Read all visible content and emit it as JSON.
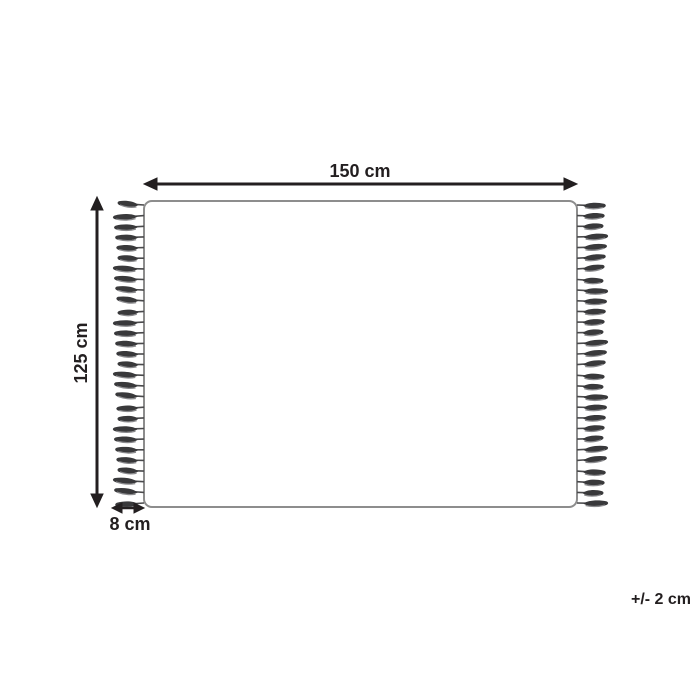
{
  "diagram": {
    "type": "product-dimension-diagram",
    "subject": "rug-with-fringe",
    "width_label": "150 cm",
    "height_label": "125 cm",
    "fringe_label": "8 cm",
    "tolerance_label": "+/- 2 cm",
    "tassels_per_side": 29,
    "colors": {
      "background": "#ffffff",
      "outline_ink": "#231f20",
      "rug_border": "#8d8d8d",
      "tassel_dark": "#39393b",
      "tassel_light": "#8a8a8d",
      "string": "#4a4a4c"
    }
  }
}
